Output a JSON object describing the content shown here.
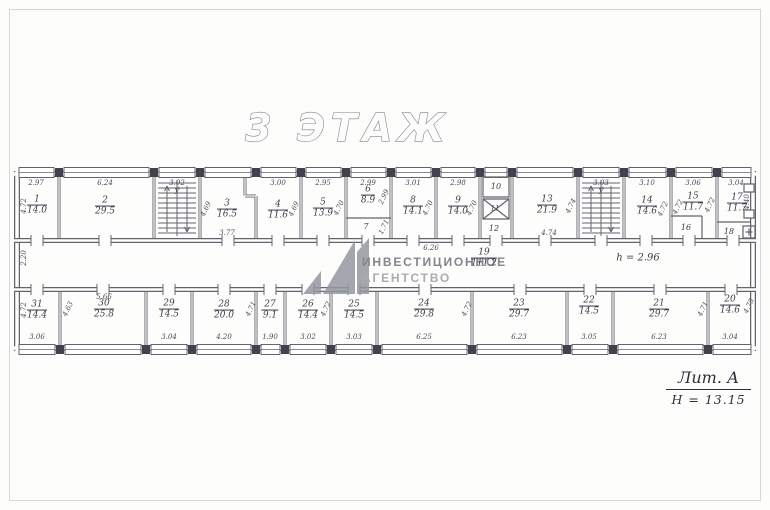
{
  "title": "3 ЭТАЖ",
  "watermark": {
    "line1": "ИНВЕСТИЦИОННОЕ",
    "line2": "АГЕНТСТВО"
  },
  "note": {
    "line1": "Лит. А",
    "line2": "Н = 13.15"
  },
  "corridor": {
    "number": "19",
    "area": "111.2",
    "height_note": "h = 2.96",
    "left_dim": "2.20"
  },
  "stairwells": [
    {
      "top_dim": "3.02",
      "mark": "Ў"
    },
    {
      "top_dim": "3.03",
      "mark": "Ў"
    }
  ],
  "rooms_top": [
    {
      "number": "1",
      "area": "14.0",
      "top": "2.97",
      "left": "4.72"
    },
    {
      "number": "2",
      "area": "29.5",
      "top": "6.24"
    },
    {
      "number": "3",
      "area": "16.5",
      "left": "4.69",
      "bottom": "3.77"
    },
    {
      "number": "4",
      "area": "11.6",
      "top": "3.00",
      "right": "4.69"
    },
    {
      "number": "5",
      "area": "13.9",
      "top": "2.95",
      "right": "4.70"
    },
    {
      "number": "6",
      "area": "8.9",
      "top": "2.99",
      "right": "2.99"
    },
    {
      "number": "7",
      "right": "1.71"
    },
    {
      "number": "8",
      "area": "14.1",
      "top": "3.01",
      "right": "4.70"
    },
    {
      "number": "9",
      "area": "14.0",
      "top": "2.98",
      "right": "4.70",
      "bottom": "6.26"
    },
    {
      "number": "10"
    },
    {
      "number": "11"
    },
    {
      "number": "12"
    },
    {
      "number": "13",
      "area": "21.9",
      "bottom": "4.74",
      "right": "4.74"
    },
    {
      "number": "14",
      "area": "14.6",
      "top": "3.10",
      "right": "4.72"
    },
    {
      "number": "15",
      "area": "11.7",
      "top": "3.06",
      "left": "4.72",
      "right": "4.72"
    },
    {
      "number": "16"
    },
    {
      "number": "17",
      "area": "11.7",
      "top": "3.04",
      "right": "4.40"
    },
    {
      "number": "18"
    }
  ],
  "rooms_bottom": [
    {
      "number": "31",
      "area": "14.4",
      "bottom": "3.06",
      "left": "4.72"
    },
    {
      "number": "30",
      "area": "25.8",
      "top": "5.66",
      "left": "4.63"
    },
    {
      "number": "29",
      "area": "14.5",
      "bottom": "3.04"
    },
    {
      "number": "28",
      "area": "20.0",
      "bottom": "4.20",
      "right": "4.71"
    },
    {
      "number": "27",
      "area": "9.1",
      "bottom": "1.90"
    },
    {
      "number": "26",
      "area": "14.4",
      "bottom": "3.02",
      "right": "4.72"
    },
    {
      "number": "25",
      "area": "14.5",
      "bottom": "3.03"
    },
    {
      "number": "24",
      "area": "29.8",
      "bottom": "6.25",
      "right": "4.72"
    },
    {
      "number": "23",
      "area": "29.7",
      "bottom": "6.23"
    },
    {
      "number": "22",
      "area": "14.5",
      "bottom": "3.05"
    },
    {
      "number": "21",
      "area": "29.7",
      "bottom": "6.23",
      "right": "4.71"
    },
    {
      "number": "20",
      "area": "14.6",
      "bottom": "3.04",
      "right": "4.75"
    }
  ]
}
